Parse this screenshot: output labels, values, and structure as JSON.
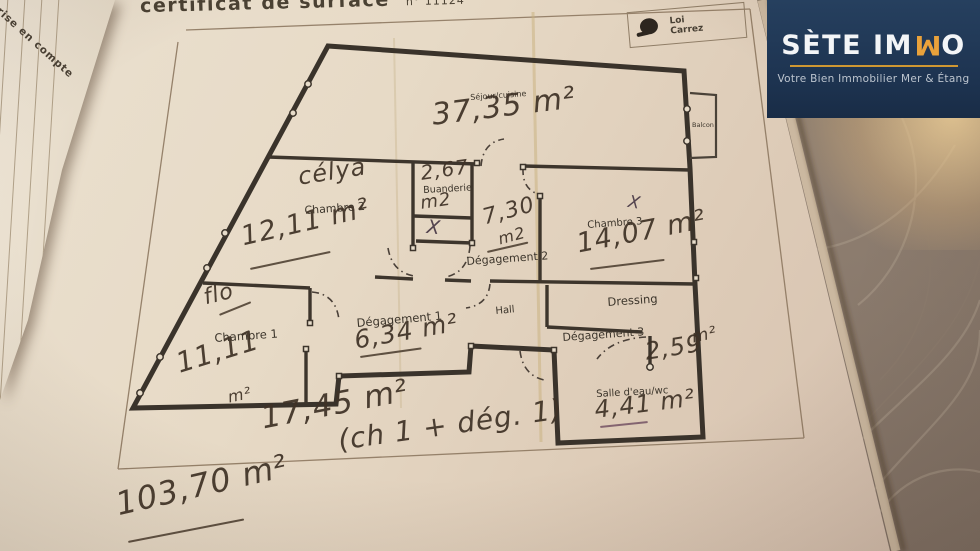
{
  "header": {
    "title": "certificat de surface",
    "number": "n° 11124"
  },
  "badge": {
    "line1": "Loi",
    "line2": "Carrez"
  },
  "side_page": {
    "text": "rise en compte"
  },
  "logo": {
    "brand_prefix": "SÈTE IM",
    "brand_flipped_letter": "M",
    "brand_suffix": "O",
    "tagline": "Votre Bien Immobilier Mer & Étang",
    "accent_color": "#e9a23b",
    "background_color": "#22384f"
  },
  "plan": {
    "rooms": {
      "sejour": {
        "label": "Séjour/cuisine",
        "area": "37,35 m²"
      },
      "balcon": {
        "label": "Balcon"
      },
      "chambre2": {
        "label": "Chambre 2",
        "area": "12,11 m²",
        "note": "célya"
      },
      "buanderie": {
        "label": "Buanderie",
        "area_value": "2,67",
        "area_unit": "m2",
        "closet_mark": "X"
      },
      "degagement2": {
        "label": "Dégagement 2",
        "area_value": "7,30",
        "area_unit": "m2"
      },
      "chambre3": {
        "label": "Chambre 3",
        "area": "14,07 m²",
        "mark": "X"
      },
      "dressing": {
        "label": "Dressing"
      },
      "chambre1": {
        "label": "Chambre 1",
        "area_value": "11,11",
        "area_unit": "m²",
        "note": "flo"
      },
      "degagement1": {
        "label": "Dégagement 1",
        "area": "6,34 m²"
      },
      "hall": {
        "label": "Hall"
      },
      "degagement3": {
        "label": "Dégagement 3",
        "area_value": "2,59",
        "area_unit": "m²"
      },
      "salle_eau": {
        "label": "Salle d'eau/wc",
        "area": "4,41 m²"
      }
    },
    "totals": {
      "partial": "17,45 m²",
      "partial_note": "(ch 1 + dég. 1)",
      "grand": "103,70 m²"
    }
  },
  "colors": {
    "pen": "#46392d",
    "pen_purple": "#53434e",
    "wall": "#3a332b"
  }
}
